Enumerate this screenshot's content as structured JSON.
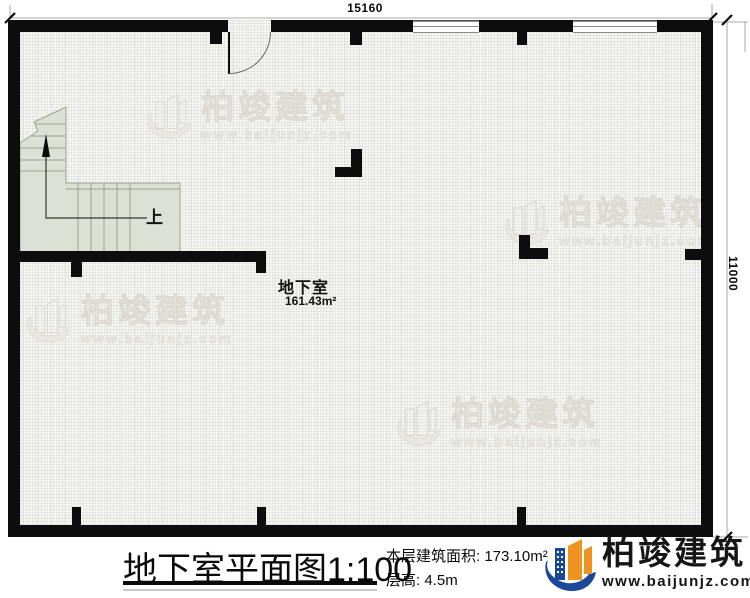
{
  "dimensions": {
    "top": "15160",
    "right": "11000"
  },
  "room": {
    "name": "地下室",
    "area": "161.43m²"
  },
  "stair": {
    "up_label": "上"
  },
  "title_block": {
    "title": "地下室平面图",
    "scale": "1:100",
    "area_label": "本层建筑面积:",
    "area_value": "173.10m²",
    "floor_height_label": "层高:",
    "floor_height_value": "4.5m"
  },
  "brand": {
    "name": "柏竣建筑",
    "url": "www.baijunjz.com"
  },
  "watermark": {
    "name": "柏竣建筑",
    "url": "www.baijunjz.com"
  },
  "colors": {
    "wall": "#0d0d0d",
    "stair_fill": "#dce0d5",
    "logo_blue": "#1c4899",
    "logo_orange": "#ef9420"
  }
}
